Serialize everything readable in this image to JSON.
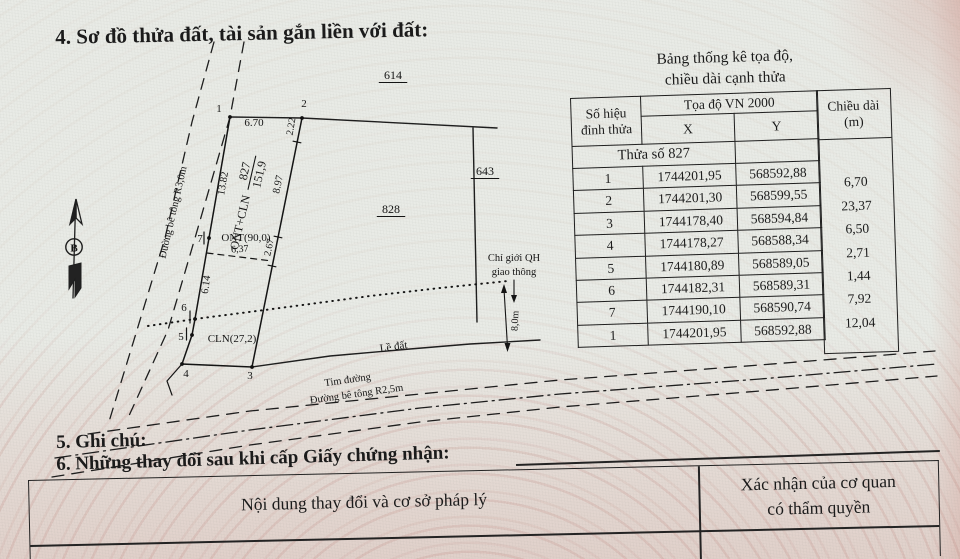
{
  "document": {
    "section4_title": "4. Sơ đồ thửa đất, tài sản gắn liền với đất:",
    "section5_title": "5. Ghi chú:",
    "section6_title": "6. Những thay đổi sau khi cấp Giấy chứng nhận:"
  },
  "coord_table": {
    "title_line1": "Bảng thống kê tọa độ,",
    "title_line2": "chiều dài cạnh thửa",
    "headers": {
      "vertex_line1": "Số hiệu",
      "vertex_line2": "đỉnh thửa",
      "coords": "Tọa độ VN 2000",
      "x": "X",
      "y": "Y",
      "length_line1": "Chiều dài",
      "length_line2": "(m)"
    },
    "parcel_row_label": "Thửa số 827",
    "rows": [
      {
        "id": "1",
        "x": "1744201,95",
        "y": "568592,88"
      },
      {
        "id": "2",
        "x": "1744201,30",
        "y": "568599,55"
      },
      {
        "id": "3",
        "x": "1744178,40",
        "y": "568594,84"
      },
      {
        "id": "4",
        "x": "1744178,27",
        "y": "568588,34"
      },
      {
        "id": "5",
        "x": "1744180,89",
        "y": "568589,05"
      },
      {
        "id": "6",
        "x": "1744182,31",
        "y": "568589,31"
      },
      {
        "id": "7",
        "x": "1744190,10",
        "y": "568590,74"
      },
      {
        "id": "1",
        "x": "1744201,95",
        "y": "568592,88"
      }
    ],
    "lengths": [
      "6,70",
      "23,37",
      "6,50",
      "2,71",
      "1,44",
      "7,92",
      "12,04"
    ]
  },
  "changes_table": {
    "left_header": "Nội dung thay đổi và cơ sở pháp lý",
    "right_header_line1": "Xác nhận của cơ quan",
    "right_header_line2": "có thẩm quyền"
  },
  "diagram": {
    "north_label": "B",
    "parcel": {
      "prefix": "ONT+CLN",
      "number": "827",
      "area": "151,9"
    },
    "labels": [
      {
        "t": "614",
        "x": 393,
        "y": 79,
        "s": 12,
        "u": true
      },
      {
        "t": "643",
        "x": 485,
        "y": 175,
        "s": 12,
        "u": true
      },
      {
        "t": "828",
        "x": 391,
        "y": 213,
        "s": 12,
        "u": true
      },
      {
        "t": "1",
        "x": 219,
        "y": 112,
        "s": 11
      },
      {
        "t": "2",
        "x": 304,
        "y": 107,
        "s": 11
      },
      {
        "t": "3",
        "x": 250,
        "y": 379,
        "s": 11
      },
      {
        "t": "4",
        "x": 186,
        "y": 377,
        "s": 11
      },
      {
        "t": "5",
        "x": 181,
        "y": 340,
        "s": 11
      },
      {
        "t": "6",
        "x": 184,
        "y": 311,
        "s": 11
      },
      {
        "t": "7",
        "x": 200,
        "y": 242,
        "s": 11
      },
      {
        "t": "6.70",
        "x": 254,
        "y": 126,
        "s": 11
      },
      {
        "t": "2.22",
        "x": 294,
        "y": 127,
        "r": -80,
        "s": 10
      },
      {
        "t": "8.97",
        "x": 281,
        "y": 185,
        "r": -78,
        "s": 10.5
      },
      {
        "t": "2.67",
        "x": 272,
        "y": 248,
        "r": -78,
        "s": 10
      },
      {
        "t": "13.82",
        "x": 226,
        "y": 184,
        "r": -80,
        "s": 10.5
      },
      {
        "t": "6.14",
        "x": 209,
        "y": 285,
        "r": -82,
        "s": 10.5
      },
      {
        "t": "6,37",
        "x": 240,
        "y": 252,
        "r": -4,
        "s": 10
      },
      {
        "t": "ONT(90,0)",
        "x": 246,
        "y": 241,
        "s": 11
      },
      {
        "t": "CLN(27,2)",
        "x": 232,
        "y": 342,
        "s": 11
      },
      {
        "t": "Đường bê tông R3,0m",
        "x": 176,
        "y": 213,
        "r": -77,
        "s": 10.5
      },
      {
        "t": "Chỉ giới QH",
        "x": 514,
        "y": 261,
        "s": 10.5
      },
      {
        "t": "giao thông",
        "x": 514,
        "y": 275,
        "s": 10.5
      },
      {
        "t": "8,0m",
        "x": 518,
        "y": 321,
        "r": -88,
        "s": 10
      },
      {
        "t": "Lề đất",
        "x": 394,
        "y": 350,
        "r": -8,
        "s": 11
      },
      {
        "t": "Tim đường",
        "x": 348,
        "y": 383,
        "r": -8,
        "s": 10.5
      },
      {
        "t": "Đường bê tông R2,5m",
        "x": 357,
        "y": 397,
        "r": -8,
        "s": 10.5
      }
    ]
  },
  "colors": {
    "ink": "#1b1b1b",
    "paper": "#e9ebe6",
    "guilloche_pink": "#c98b80"
  }
}
